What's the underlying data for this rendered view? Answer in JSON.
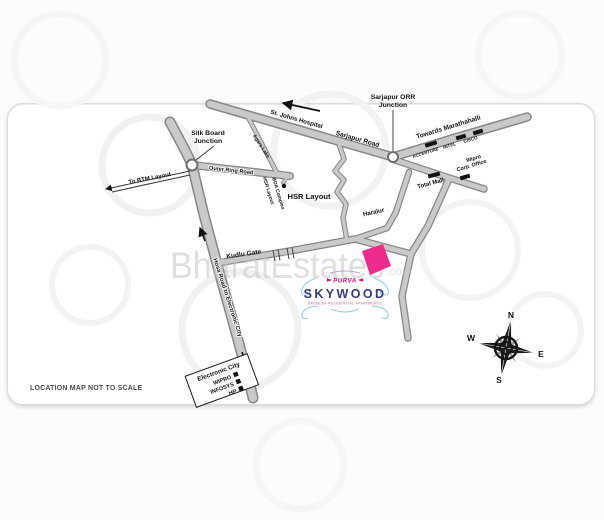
{
  "watermark": {
    "text": "BharatEstates",
    "suffix": ".com"
  },
  "footer_note": "LOCATION MAP NOT TO SCALE",
  "map": {
    "labels": {
      "silk_board_1": "Silk Board",
      "silk_board_2": "Junction",
      "st_johns_hospital": "St. Johns Hospital",
      "sarjapur_road": "Sarjapur Road",
      "orr_junction_1": "Sarjapur ORR",
      "orr_junction_2": "Junction",
      "towards_marathahalli": "Towards Marathahalli",
      "accenture": "ACCENTURE",
      "intel": "INTEL",
      "cisco": "CISCO",
      "wipro_1": "Wipro",
      "wipro_2": "Corp. Office",
      "total_mall": "Total Mall",
      "agara_lake": "Agara Lake",
      "outer_ring_road": "Outer Ring Road",
      "to_btm_layout": "To BTM Layout",
      "hsr_bda_1": "HSR Layout",
      "hsr_bda_2": "BDA Complex",
      "hsr_layout": "HSR Layout",
      "haralur": "Haralur",
      "kudlu_gate": "Kudlu Gate",
      "hosa_road": "Hosa Road to Electronic City",
      "electronic_city": "Electronic City",
      "ec_companies": [
        "WIPRO",
        "INFOSYS",
        "HP"
      ]
    },
    "logo": {
      "brand": "PURVA",
      "name": "SKYWOOD",
      "tagline": "PREMIUM RESIDENTIAL APARTMENTS"
    },
    "compass": {
      "north": "N",
      "east": "E",
      "south": "S",
      "west": "W"
    },
    "colors": {
      "site_plot": "#ed2b8d",
      "road_fill": "#c9c9c9",
      "road_edge": "#878787",
      "logo_brand": "#e5007d",
      "logo_name": "#3a3a80",
      "flourish": "#8fd0e2",
      "watermark": "#c6c6c6"
    }
  }
}
